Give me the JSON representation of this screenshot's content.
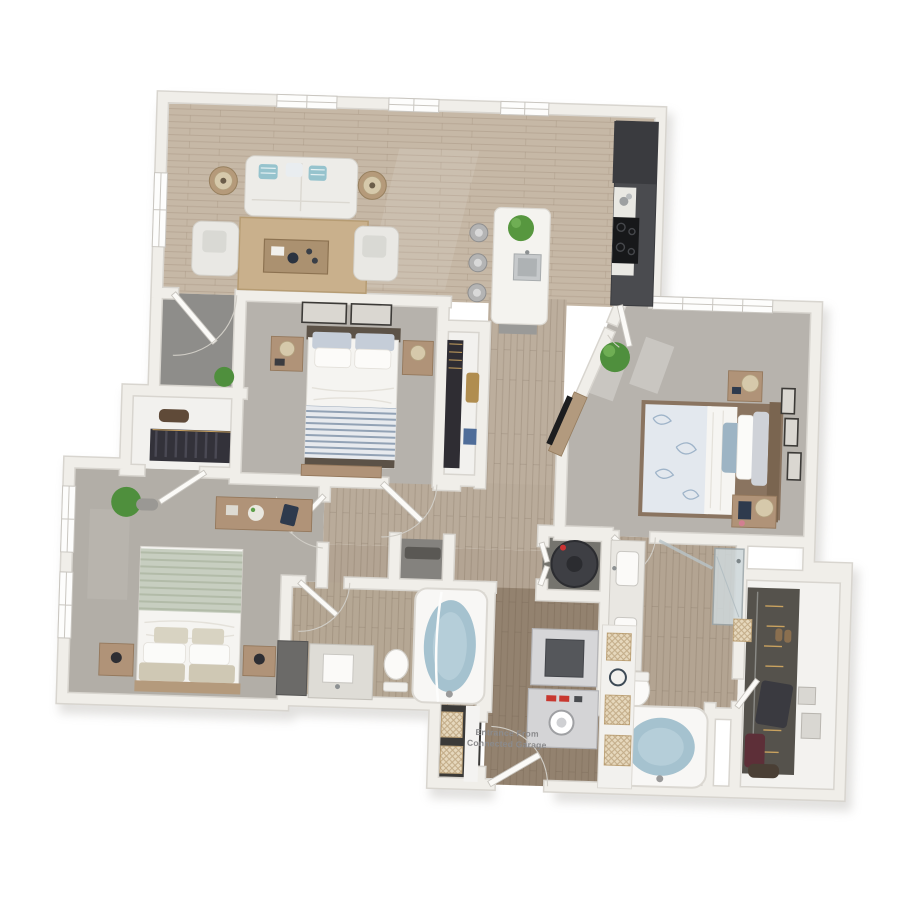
{
  "scene": {
    "type": "3D apartment floor plan rendering, top-down view",
    "bedrooms": 3,
    "bathrooms": 2
  },
  "entrance_label": {
    "line1": "Entrance From",
    "line2": "Connected Garage"
  },
  "palette": {
    "background": "#ffffff",
    "wall_fill": "#f0eee9",
    "wall_edge": "#d8d5cf",
    "wood_floor": "#c4b5a2",
    "dark_wood_floor": "#8f7e6d",
    "carpet": "#b5b1ab",
    "porch_concrete": "#8e8d8a",
    "water": "#a5c2cf",
    "kitchen_cabinets": "#4a4b4f",
    "accent_teal": "#96c3cd",
    "accent_sage": "#c6cdbf",
    "accent_floral_blue": "#9db4c4",
    "wood_furniture": "#b09378"
  },
  "rooms": [
    {
      "name": "Living Room",
      "furniture": [
        "sofa with teal pillows",
        "two armchairs",
        "coffee table",
        "jute area rug",
        "two side tables with lamps",
        "three windows"
      ]
    },
    {
      "name": "Kitchen",
      "furniture": [
        "island with sink",
        "three bar stools",
        "potted plant",
        "cooktop",
        "dark cabinet run",
        "refrigerator",
        "window"
      ]
    },
    {
      "name": "Entry Porch",
      "furniture": [
        "front door",
        "potted plant"
      ]
    },
    {
      "name": "Bedroom 2",
      "furniture": [
        "bed with striped blanket",
        "two nightstands with lamps",
        "two wall frames",
        "dresser",
        "reach-in closet with hanging clothes"
      ]
    },
    {
      "name": "Master Bedroom",
      "furniture": [
        "bed with floral duvet",
        "two nightstands with lamps",
        "tv console on angled wall",
        "potted palm",
        "three wall frames",
        "large window"
      ]
    },
    {
      "name": "Bedroom 3",
      "furniture": [
        "bed with sage blanket",
        "two nightstands with lamps",
        "dresser with flowers and tablet",
        "potted plant",
        "closet with hanging clothes",
        "two windows"
      ]
    },
    {
      "name": "Hall Bathroom",
      "furniture": [
        "vanity with sink",
        "storage cabinet",
        "toilet",
        "bathtub filled with water"
      ]
    },
    {
      "name": "Master Bathroom",
      "furniture": [
        "double vanity",
        "toilet",
        "soaking tub filled with water",
        "glass shower"
      ]
    },
    {
      "name": "Walk-in Closet",
      "furniture": [
        "hanging rod with clothes",
        "shoes",
        "storage boxes",
        "basket",
        "duffel bag"
      ]
    },
    {
      "name": "Laundry Mudroom",
      "furniture": [
        "dryer",
        "washer",
        "basket shelving unit",
        "storage closet with baskets",
        "door from garage"
      ]
    },
    {
      "name": "Utility Closet",
      "furniture": [
        "water heater"
      ]
    },
    {
      "name": "Hall Closet",
      "furniture": []
    }
  ]
}
